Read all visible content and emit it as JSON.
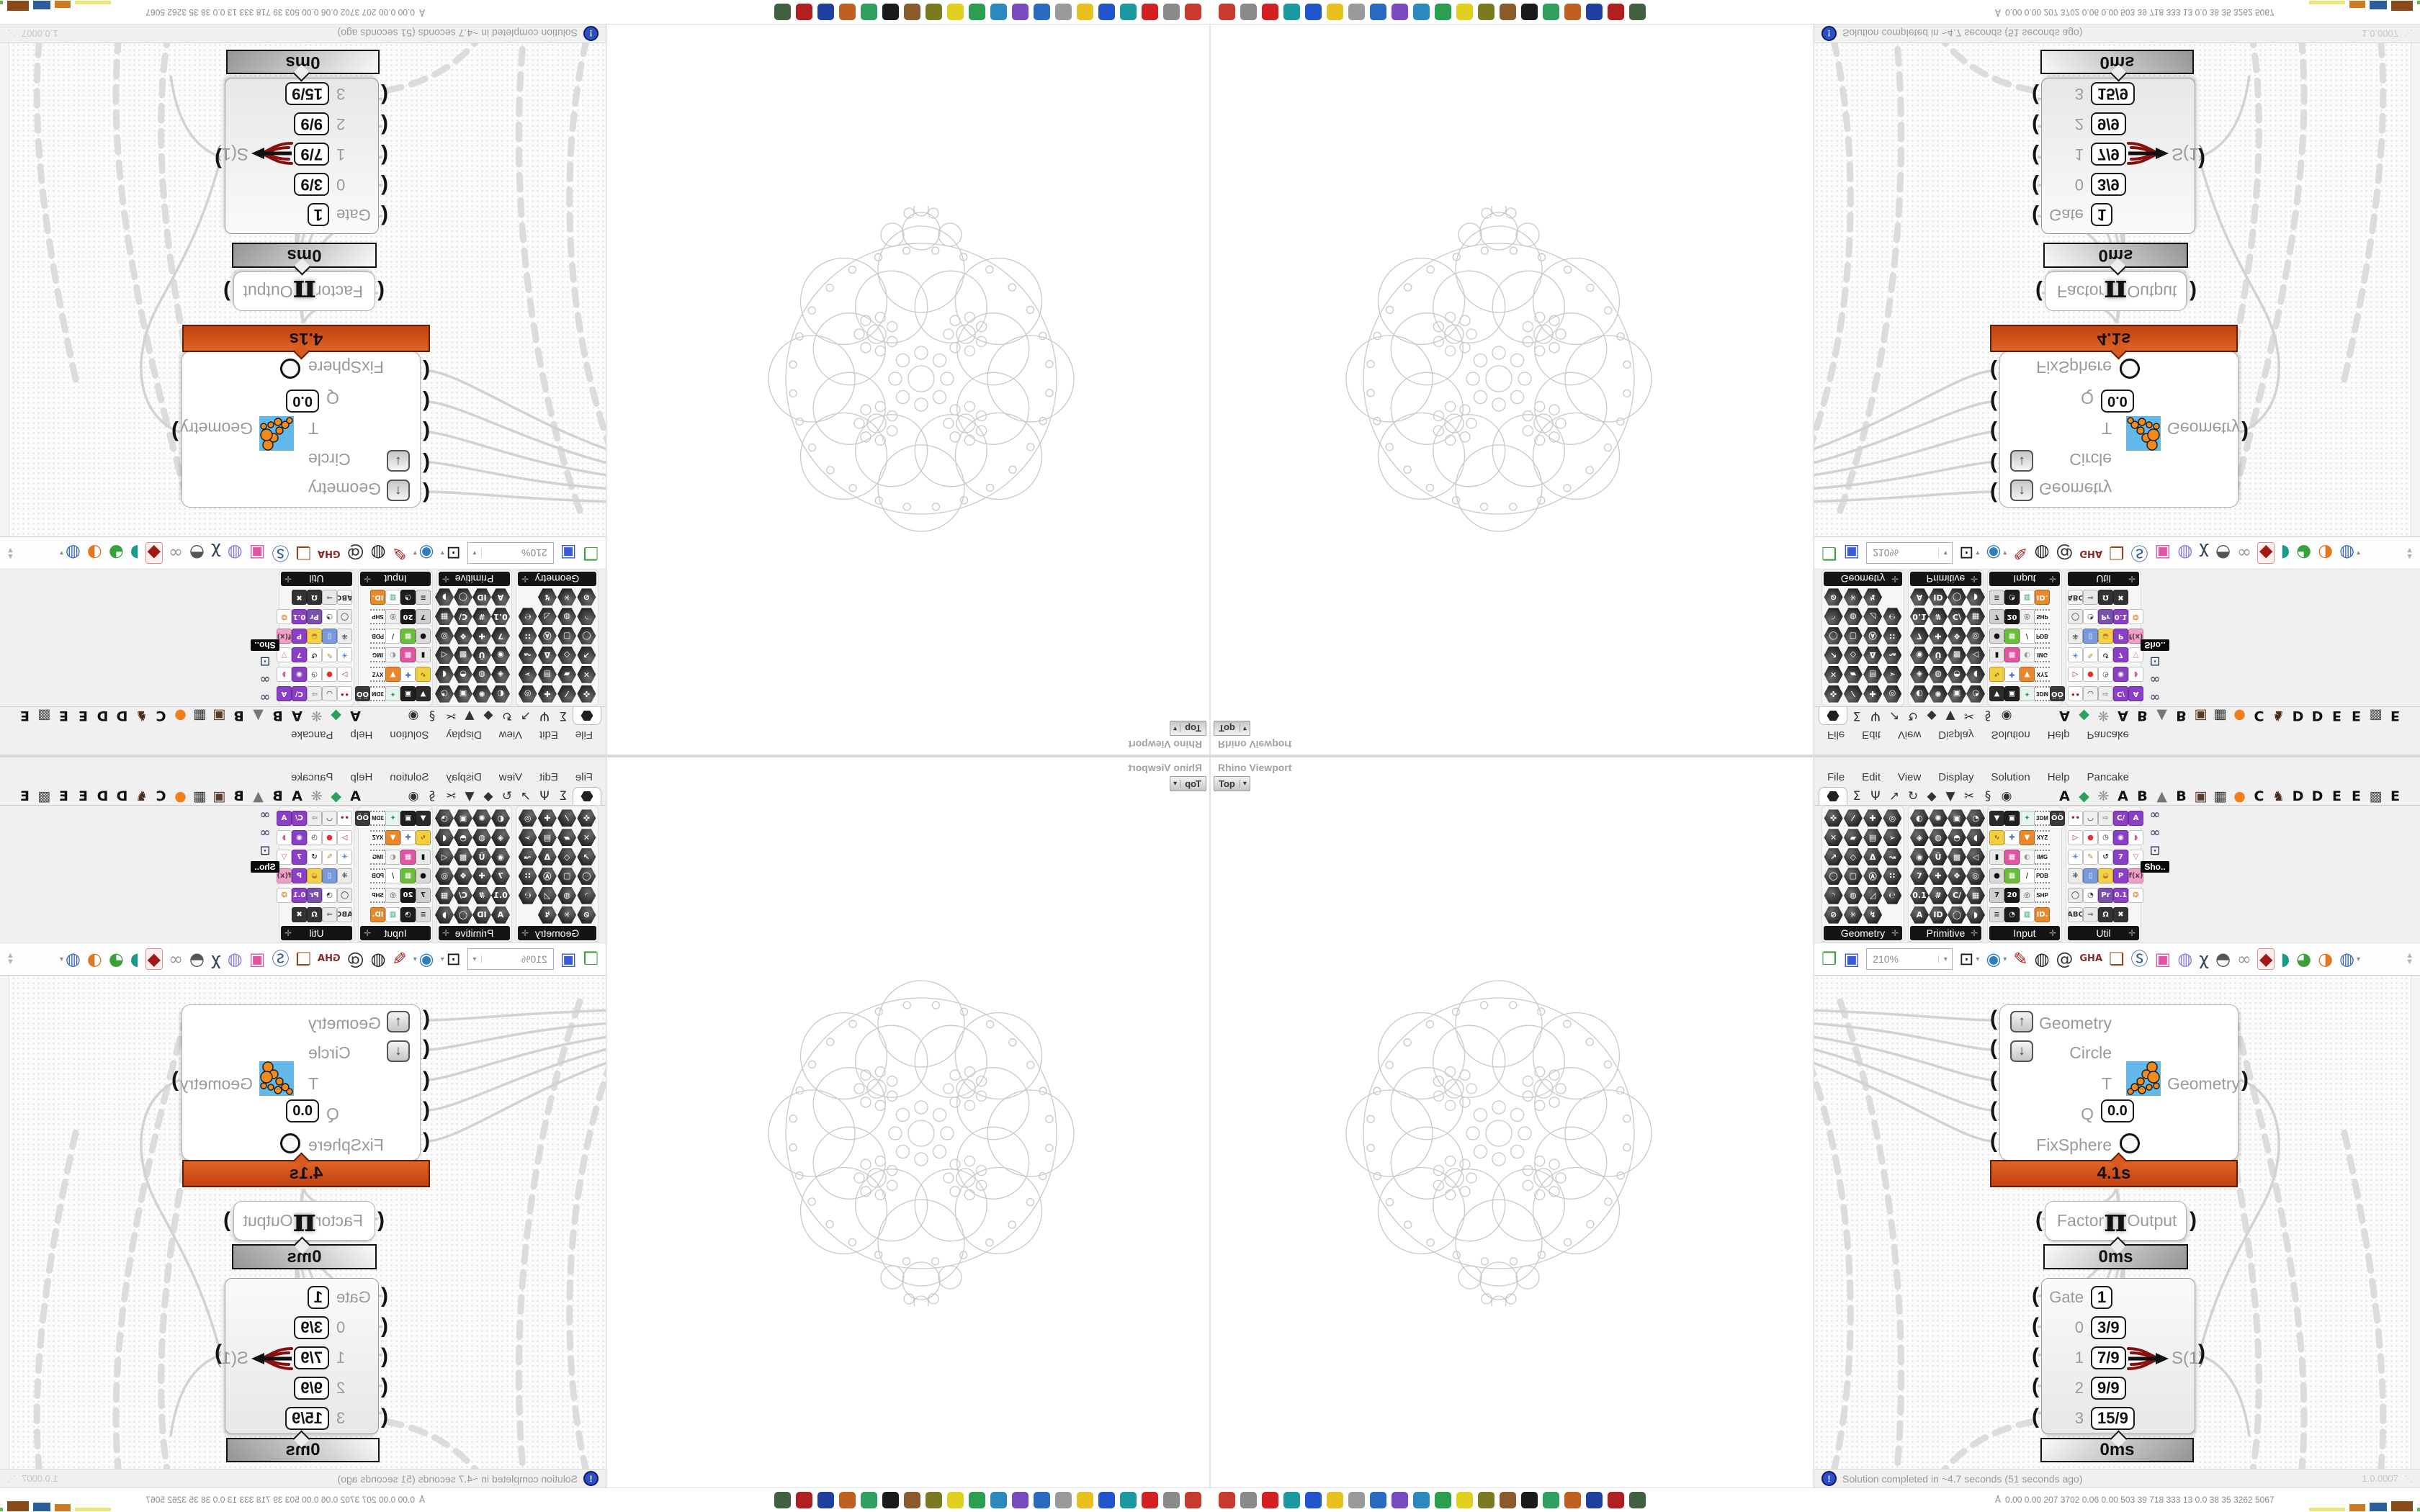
{
  "rhino": {
    "pane_title": "Rhino Viewport",
    "viewport_button": "Top",
    "viewport_caret": "▾"
  },
  "gh": {
    "menus": [
      "File",
      "Edit",
      "View",
      "Display",
      "Solution",
      "Help",
      "Pancake"
    ],
    "tab_glyphs": [
      "Σ",
      "Ψ",
      "↗",
      "↻",
      "◆",
      "▼",
      "✂",
      "§",
      "◉"
    ],
    "tab_letters": [
      [
        "A",
        "#111"
      ],
      [
        "◆",
        "#2aa05a"
      ],
      [
        "❋",
        "#999"
      ],
      [
        "A",
        "#111"
      ],
      [
        "B",
        "#111"
      ],
      [
        "▲",
        "#777"
      ],
      [
        "B",
        "#111"
      ],
      [
        "▣",
        "#5a3a2a"
      ],
      [
        "▦",
        "#333"
      ],
      [
        "●",
        "#ef7f1a"
      ],
      [
        "C",
        "#111"
      ],
      [
        "♞",
        "#4a2a1a"
      ],
      [
        "D",
        "#111"
      ],
      [
        "D",
        "#111"
      ],
      [
        "E",
        "#111"
      ],
      [
        "E",
        "#111"
      ],
      [
        "▩",
        "#555"
      ],
      [
        "E",
        "#111"
      ]
    ],
    "palette": [
      {
        "label": "Geometry",
        "kind": "hex",
        "cols": 4,
        "icons": [
          "✜",
          "⁄",
          "✚",
          "◎",
          "✕",
          "▰",
          "▤",
          "➢",
          "↗",
          "◇",
          "Δ",
          "↝",
          "◯",
          "▢",
          "Ⓐ",
          "∷",
          "◝",
          "◍",
          "◿",
          "℮",
          "⊘",
          "✳",
          "↯"
        ]
      },
      {
        "label": "Primitive",
        "kind": "hex",
        "cols": 4,
        "icons": [
          "◐",
          "✺",
          "▣",
          "◔",
          "◈",
          "◍",
          "◓",
          "◖",
          "◉",
          "Ü",
          "▩",
          "◁",
          "7",
          "✚",
          "❖",
          "◎",
          "0.1",
          "#",
          "C/",
          "▦",
          "A",
          "ID",
          "◯",
          "◗"
        ]
      },
      {
        "label": "Input",
        "kind": "sq",
        "cols": 5,
        "icons": [
          {
            "t": "▼",
            "c": "#2b2b2b",
            "f": "#fff"
          },
          {
            "t": "▣",
            "c": "#1e1e1e",
            "f": "#fff"
          },
          {
            "t": "✦",
            "c": "#e9f4ec",
            "f": "#2a9d6a"
          },
          {
            "t": "3DM",
            "tag": 1
          },
          {
            "t": "ÖÖ",
            "c": "#3a3a3a",
            "f": "#fff"
          },
          {
            "t": "∿",
            "c": "#f2cf3e",
            "f": "#7a6a10"
          },
          {
            "t": "✚",
            "c": "#ffffff",
            "f": "#3a6ac9"
          },
          {
            "t": "▼",
            "c": "#e8882a",
            "f": "#fff"
          },
          {
            "t": "XYZ",
            "tag": 1
          },
          null,
          {
            "t": "▮",
            "c": "#e9e9e9",
            "f": "#111"
          },
          {
            "t": "▦",
            "c": "#e255a5",
            "f": "#fff"
          },
          {
            "t": "◐",
            "c": "#f5f5f5",
            "f": "#9a9a9a"
          },
          {
            "t": "IMG",
            "tag": 1
          },
          null,
          {
            "t": "●",
            "c": "#d9d9d9",
            "f": "#111"
          },
          {
            "t": "▦",
            "c": "#6abf3a",
            "f": "#fff"
          },
          {
            "t": "∕",
            "c": "#ffffff",
            "f": "#333"
          },
          {
            "t": "PDB",
            "tag": 1
          },
          null,
          {
            "t": "7",
            "c": "#cfcfcf",
            "f": "#222"
          },
          {
            "t": "20",
            "c": "#181818",
            "f": "#fff"
          },
          {
            "t": "◎",
            "c": "#efefef",
            "f": "#444"
          },
          {
            "t": "SHP",
            "tag": 1
          },
          null,
          {
            "t": "≡",
            "c": "#dcdcdc",
            "f": "#333"
          },
          {
            "t": "◔",
            "c": "#1c1c1c",
            "f": "#fff"
          },
          {
            "t": "▥",
            "c": "#ffffff",
            "f": "#2a9d6a"
          },
          {
            "t": "ID.",
            "c": "#e8882a",
            "f": "#fff"
          },
          null
        ]
      },
      {
        "label": "Util",
        "kind": "sq",
        "cols": 5,
        "icons": [
          {
            "t": "••",
            "c": "#ffffff",
            "f": "#c01818"
          },
          {
            "t": "◡",
            "c": "#f0f0f0",
            "f": "#111"
          },
          {
            "t": "⇨",
            "c": "#ededed",
            "f": "#888"
          },
          {
            "t": "C/",
            "c": "#8b3fc6",
            "f": "#fff"
          },
          {
            "t": "A",
            "c": "#8b3fc6",
            "f": "#fff"
          },
          {
            "t": "▷",
            "c": "#ffffff",
            "f": "#a02020"
          },
          {
            "t": "●",
            "c": "#ffffff",
            "f": "#e03030"
          },
          {
            "t": "◷",
            "c": "#ffffff",
            "f": "#333"
          },
          {
            "t": "◉",
            "c": "#8b3fc6",
            "f": "#fff"
          },
          {
            "t": "◗",
            "c": "#ffffff",
            "f": "#d4589d"
          },
          {
            "t": "✳",
            "c": "#ffffff",
            "f": "#2a62c9"
          },
          {
            "t": "✎",
            "c": "#ffffff",
            "f": "#b5862a"
          },
          {
            "t": "↺",
            "c": "#ffffff",
            "f": "#333"
          },
          {
            "t": "7",
            "c": "#8b3fc6",
            "f": "#fff"
          },
          {
            "t": "▽",
            "c": "#ffffff",
            "f": "#d4589d"
          },
          {
            "t": "❋",
            "c": "#ededed",
            "f": "#555"
          },
          {
            "t": "▯",
            "c": "#7a9ae0",
            "f": "#fff"
          },
          {
            "t": "◒",
            "c": "#f5d04a",
            "f": "#b5862a"
          },
          {
            "t": "P",
            "c": "#8b3fc6",
            "f": "#fff"
          },
          {
            "t": "f(x)",
            "c": "#f0a0c8",
            "f": "#5a3a4a"
          },
          {
            "t": "◯",
            "c": "#ededed",
            "f": "#222"
          },
          {
            "t": "◔",
            "c": "#ffffff",
            "f": "#333"
          },
          {
            "t": "Pr",
            "c": "#7b52ab",
            "f": "#fff"
          },
          {
            "t": "0.1",
            "c": "#8b3fc6",
            "f": "#fff"
          },
          {
            "t": "❂",
            "c": "#ffffff",
            "f": "#e07820"
          },
          {
            "t": "ABC",
            "c": "#f5f5f5",
            "f": "#333"
          },
          {
            "t": "⇒",
            "c": "#e8e8e8",
            "f": "#666"
          },
          {
            "t": "Ω",
            "c": "#333333",
            "f": "#fff"
          },
          {
            "t": "✖",
            "c": "#333333",
            "f": "#fff"
          },
          null
        ]
      }
    ],
    "display_toggles": [
      "∞",
      "∞",
      "⊡"
    ],
    "display_tooltip": "Sho..",
    "toolbar": {
      "zoom_value": "210%",
      "items": [
        {
          "t": "❐",
          "f": "#3f9e3f"
        },
        {
          "t": "▣",
          "f": "#3b5bd6"
        },
        {
          "combo": true
        },
        {
          "t": "⊡",
          "f": "#1a1a1a",
          "dd": true
        },
        {
          "t": "◉",
          "f": "#2e7fbe",
          "dd": true
        },
        {
          "t": "✎",
          "f": "#b22222"
        },
        {
          "t": "◍",
          "f": "#1a1a1a"
        },
        {
          "t": "@",
          "f": "#333333"
        },
        {
          "t": "GHA",
          "f": "#8a2a2a",
          "small": true
        },
        {
          "t": "❏",
          "f": "#8a4a2a"
        },
        {
          "t": "Ⓢ",
          "f": "#2a5a9a"
        },
        {
          "t": "▣",
          "f": "#e255a5"
        },
        {
          "t": "◍",
          "f": "#8a7ae0"
        },
        {
          "t": "χ",
          "f": "#33405e"
        },
        {
          "t": "◓",
          "f": "#555555"
        },
        {
          "t": "∞",
          "f": "#999999"
        },
        {
          "t": "◆",
          "f": "#a01818",
          "sel": true
        },
        {
          "t": "◗",
          "f": "#1a9a8a"
        },
        {
          "t": "◕",
          "f": "#3aa03a"
        },
        {
          "t": "◑",
          "f": "#e07820"
        },
        {
          "t": "◍",
          "f": "#3a6ac9",
          "dd": true
        }
      ]
    },
    "canvas": {
      "fixsphere": {
        "in_geometry": "Geometry",
        "in_circle": "Circle",
        "in_t": "T",
        "in_q": "Q",
        "q_value": "0.0",
        "in_fix": "FixSphere",
        "out_geometry": "Geometry",
        "time": "4.1s"
      },
      "pi": {
        "in": "Factor",
        "symbol": "π",
        "out": "Output",
        "time": "0ms"
      },
      "gate": {
        "rows": [
          [
            "Gate",
            "1"
          ],
          [
            "0",
            "3/9"
          ],
          [
            "1",
            "7/9"
          ],
          [
            "2",
            "9/9"
          ],
          [
            "3",
            "15/9"
          ]
        ],
        "out": "S(1)",
        "time": "0ms"
      }
    },
    "status": {
      "icon": "!",
      "message": "Solution completed in ~4.7 seconds (51 seconds ago)",
      "version": "1.0.0007"
    }
  },
  "taskbar": {
    "app_icon_colors": [
      "#c93a2e",
      "#8a8a8a",
      "#d42020",
      "#1a9aa0",
      "#2255cc",
      "#e8c020",
      "#9a9a9a",
      "#2a6ac0",
      "#7a4ac0",
      "#2a8ac0",
      "#28a050",
      "#e0d020",
      "#7a7a20",
      "#8a5a2a",
      "#1a1a1a",
      "#30a060",
      "#c06020",
      "#2040a0",
      "#b02020",
      "#406040"
    ],
    "monitor_prefix": "Å",
    "monitor_values": "0.00  0.00  207  3702  0.06  0.00  503   39   718   333   13   0.0   38   35  3262 5067",
    "meters": [
      {
        "c": "#ece27a",
        "w": 50,
        "h": 5
      },
      {
        "c": "#cf7a22",
        "w": 22,
        "h": 10
      },
      {
        "c": "#2b5d9e",
        "w": 24,
        "h": 12
      },
      {
        "c": "#8a4a1a",
        "w": 30,
        "h": 14
      },
      {
        "c": "#63b84f",
        "w": 14,
        "h": 5
      },
      {
        "c": "#c03a2a",
        "w": 10,
        "h": 6
      }
    ]
  },
  "accent_colors": {
    "group_time_bar": "#c2410f",
    "wire": "#d2d2d2",
    "canvas_dot": "#e4e4e4"
  }
}
